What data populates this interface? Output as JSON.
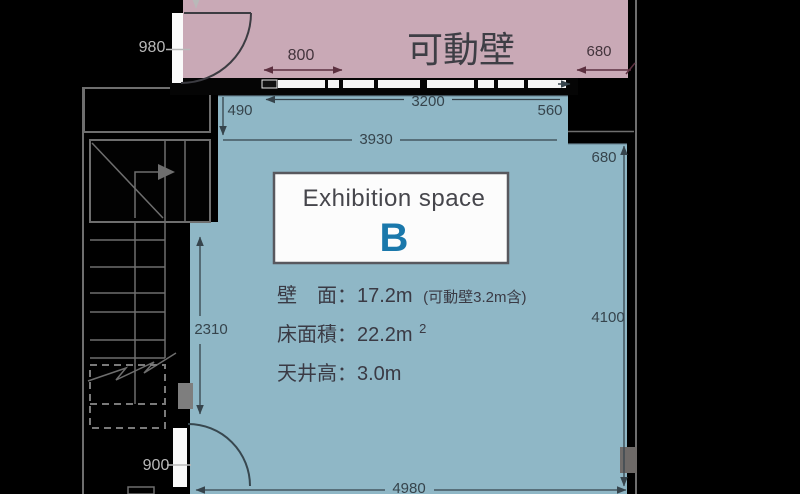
{
  "room_a": {
    "title": "可動壁"
  },
  "room_b": {
    "label": {
      "line1": "Exhibition space",
      "letter": "B"
    },
    "specs": {
      "wall": "壁　面：17.2m",
      "wall_note": "(可動壁3.2m含)",
      "floor_area": "床面積：22.2m",
      "floor_area_sup": "2",
      "ceiling_height": "天井高：3.0m"
    }
  },
  "dimensions": {
    "door_top": "980",
    "wall_section": "800",
    "top_right_offset": "680",
    "top_inset": "490",
    "movable_wall_length": "3200",
    "wall_stub": "560",
    "upper_width": "3930",
    "right_offset": "680",
    "right_height": "4100",
    "left_height": "2310",
    "door_bottom": "900",
    "bottom_width": "4980"
  },
  "colors": {
    "background": "#000000",
    "room_a_fill": "#c9a9b6",
    "room_b_fill": "#8fb7c6",
    "accent_letter": "#1a78ab"
  }
}
